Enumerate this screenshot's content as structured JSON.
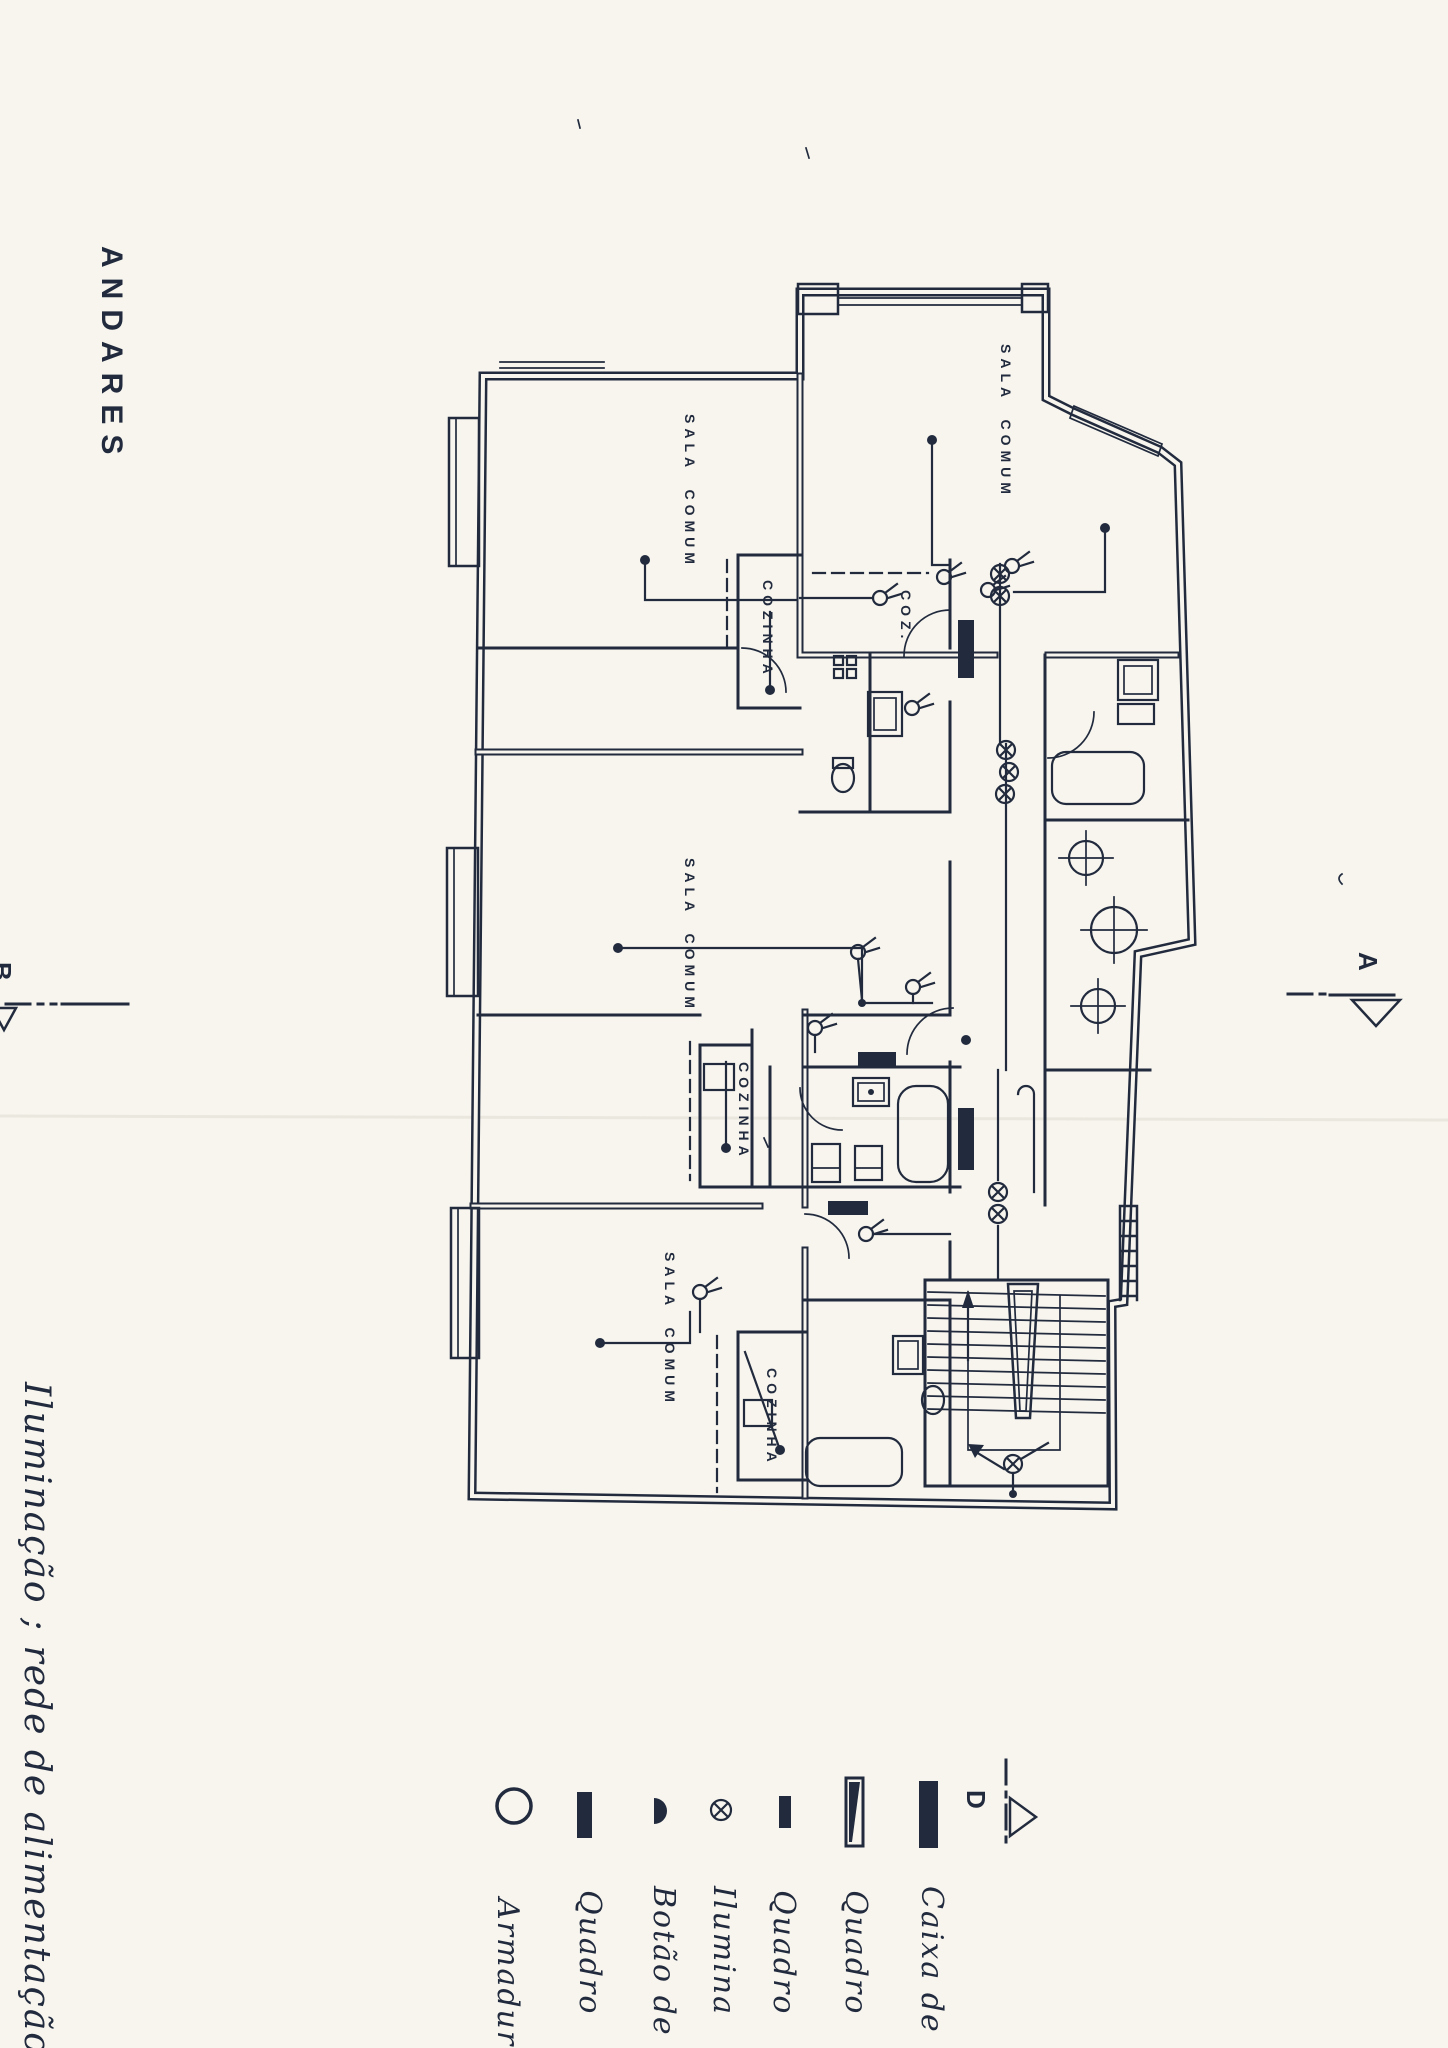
{
  "title": "ANDARES",
  "caption": "Iluminação ; rede de alimentação",
  "rooms": {
    "sala_top_right": "SALA COMUM",
    "sala_upper_left": "SALA COMUM",
    "cozinha_upper": "COZINHA",
    "coz_partial": "COZ.",
    "sala_middle": "SALA COMUM",
    "cozinha_middle": "COZINHA",
    "sala_bottom": "SALA COMUM",
    "cozinha_bottom": "COZINHA"
  },
  "section_markers": {
    "a": "A",
    "b": "B",
    "d": "D"
  },
  "legend": {
    "items": [
      {
        "icon": "light-fixture-circle-icon",
        "label": "Armadur"
      },
      {
        "icon": "panel-solid-bar-icon",
        "label": "Quadro"
      },
      {
        "icon": "pushbutton-half-circle-icon",
        "label": "Botão de"
      },
      {
        "icon": "ceiling-light-crossed-circle-icon",
        "label": "Ilumina"
      },
      {
        "icon": "panel-small-bar-icon",
        "label": "Quadro"
      },
      {
        "icon": "panel-outline-bar-icon",
        "label": "Quadro"
      },
      {
        "icon": "junction-box-thick-bar-icon",
        "label": "Caixa de"
      }
    ]
  },
  "colors": {
    "paper": "#f7f5ee",
    "ink": "#222b3e"
  }
}
